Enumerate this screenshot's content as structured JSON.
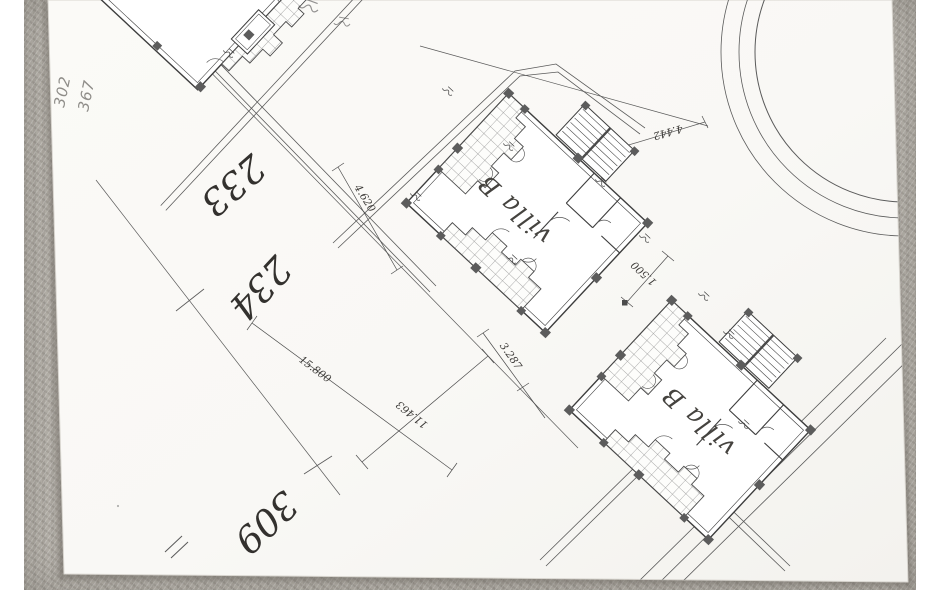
{
  "photo": {
    "handwritten_notes": [
      "302",
      "367"
    ],
    "plot_numbers": [
      "233",
      "234",
      "309"
    ],
    "villa_labels": {
      "center_villa": "villa B",
      "bottom_villa": "villa B"
    },
    "dimensions": {
      "top": "4.620",
      "left_long": "15.800",
      "diagonal": "11.463",
      "middle": "3.287",
      "small": "1.500",
      "roundabout": "4.442"
    },
    "colors": {
      "paper": "#faf9f6",
      "carpet": "#b6b2ab",
      "ink": "#44423e",
      "pencil": "#8f8d89"
    }
  }
}
